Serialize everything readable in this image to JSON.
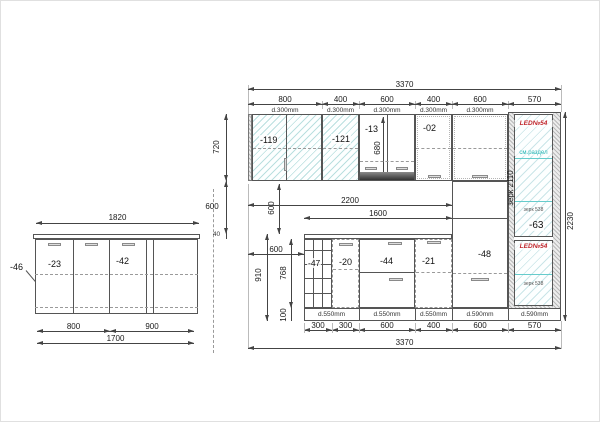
{
  "island": {
    "top_width": "1820",
    "counter_label": "-46",
    "left_cabinet_label": "-23",
    "right_cabinet_label": "-42",
    "bottom_dims": [
      "800",
      "900"
    ],
    "total_width": "1700"
  },
  "elevation": {
    "top_total": "3370",
    "top_dims": [
      "800",
      "400",
      "600",
      "400",
      "600",
      "570"
    ],
    "top_depths": [
      "d.300mm",
      "d.300mm",
      "d.300mm",
      "d.300mm",
      "d.300mm"
    ],
    "upper_labels": {
      "glass_double": "-119",
      "glass_single": "-121",
      "hood_cabinet": "-13",
      "shelf_cabinet": "-02"
    },
    "hood_opening_height": "680",
    "heights": {
      "upper_row": "720",
      "backsplash": "600",
      "countertop": "40",
      "backsplash_inner": "600",
      "base_total": "910",
      "base_cabinet": "768",
      "plinth": "100",
      "tall_cabinet": "2230"
    },
    "widths": {
      "wall_gap": "600",
      "counter_run": "2200",
      "base_run": "1600"
    },
    "base_labels": {
      "wine_rack": "-47",
      "open_cabinet": "-20",
      "drawer_cabinet": "-44",
      "door_cabinet": "-21",
      "tall_column": "-48"
    },
    "tall_cabinet": {
      "led_top": "LED№54",
      "led_bottom": "LED№54",
      "section_note": "см.раздел",
      "mirror_height_note": "зерк 2110",
      "mirror_note_upper": "зерк 538",
      "mirror_note_lower": "зерк 538",
      "label": "-63"
    },
    "bottom_dims": [
      "300",
      "300",
      "600",
      "400",
      "600",
      "570"
    ],
    "bottom_depths": [
      "d.550mm",
      "d.550mm",
      "d.550mm",
      "d.590mm",
      "d.590mm"
    ],
    "bottom_total": "3370"
  }
}
